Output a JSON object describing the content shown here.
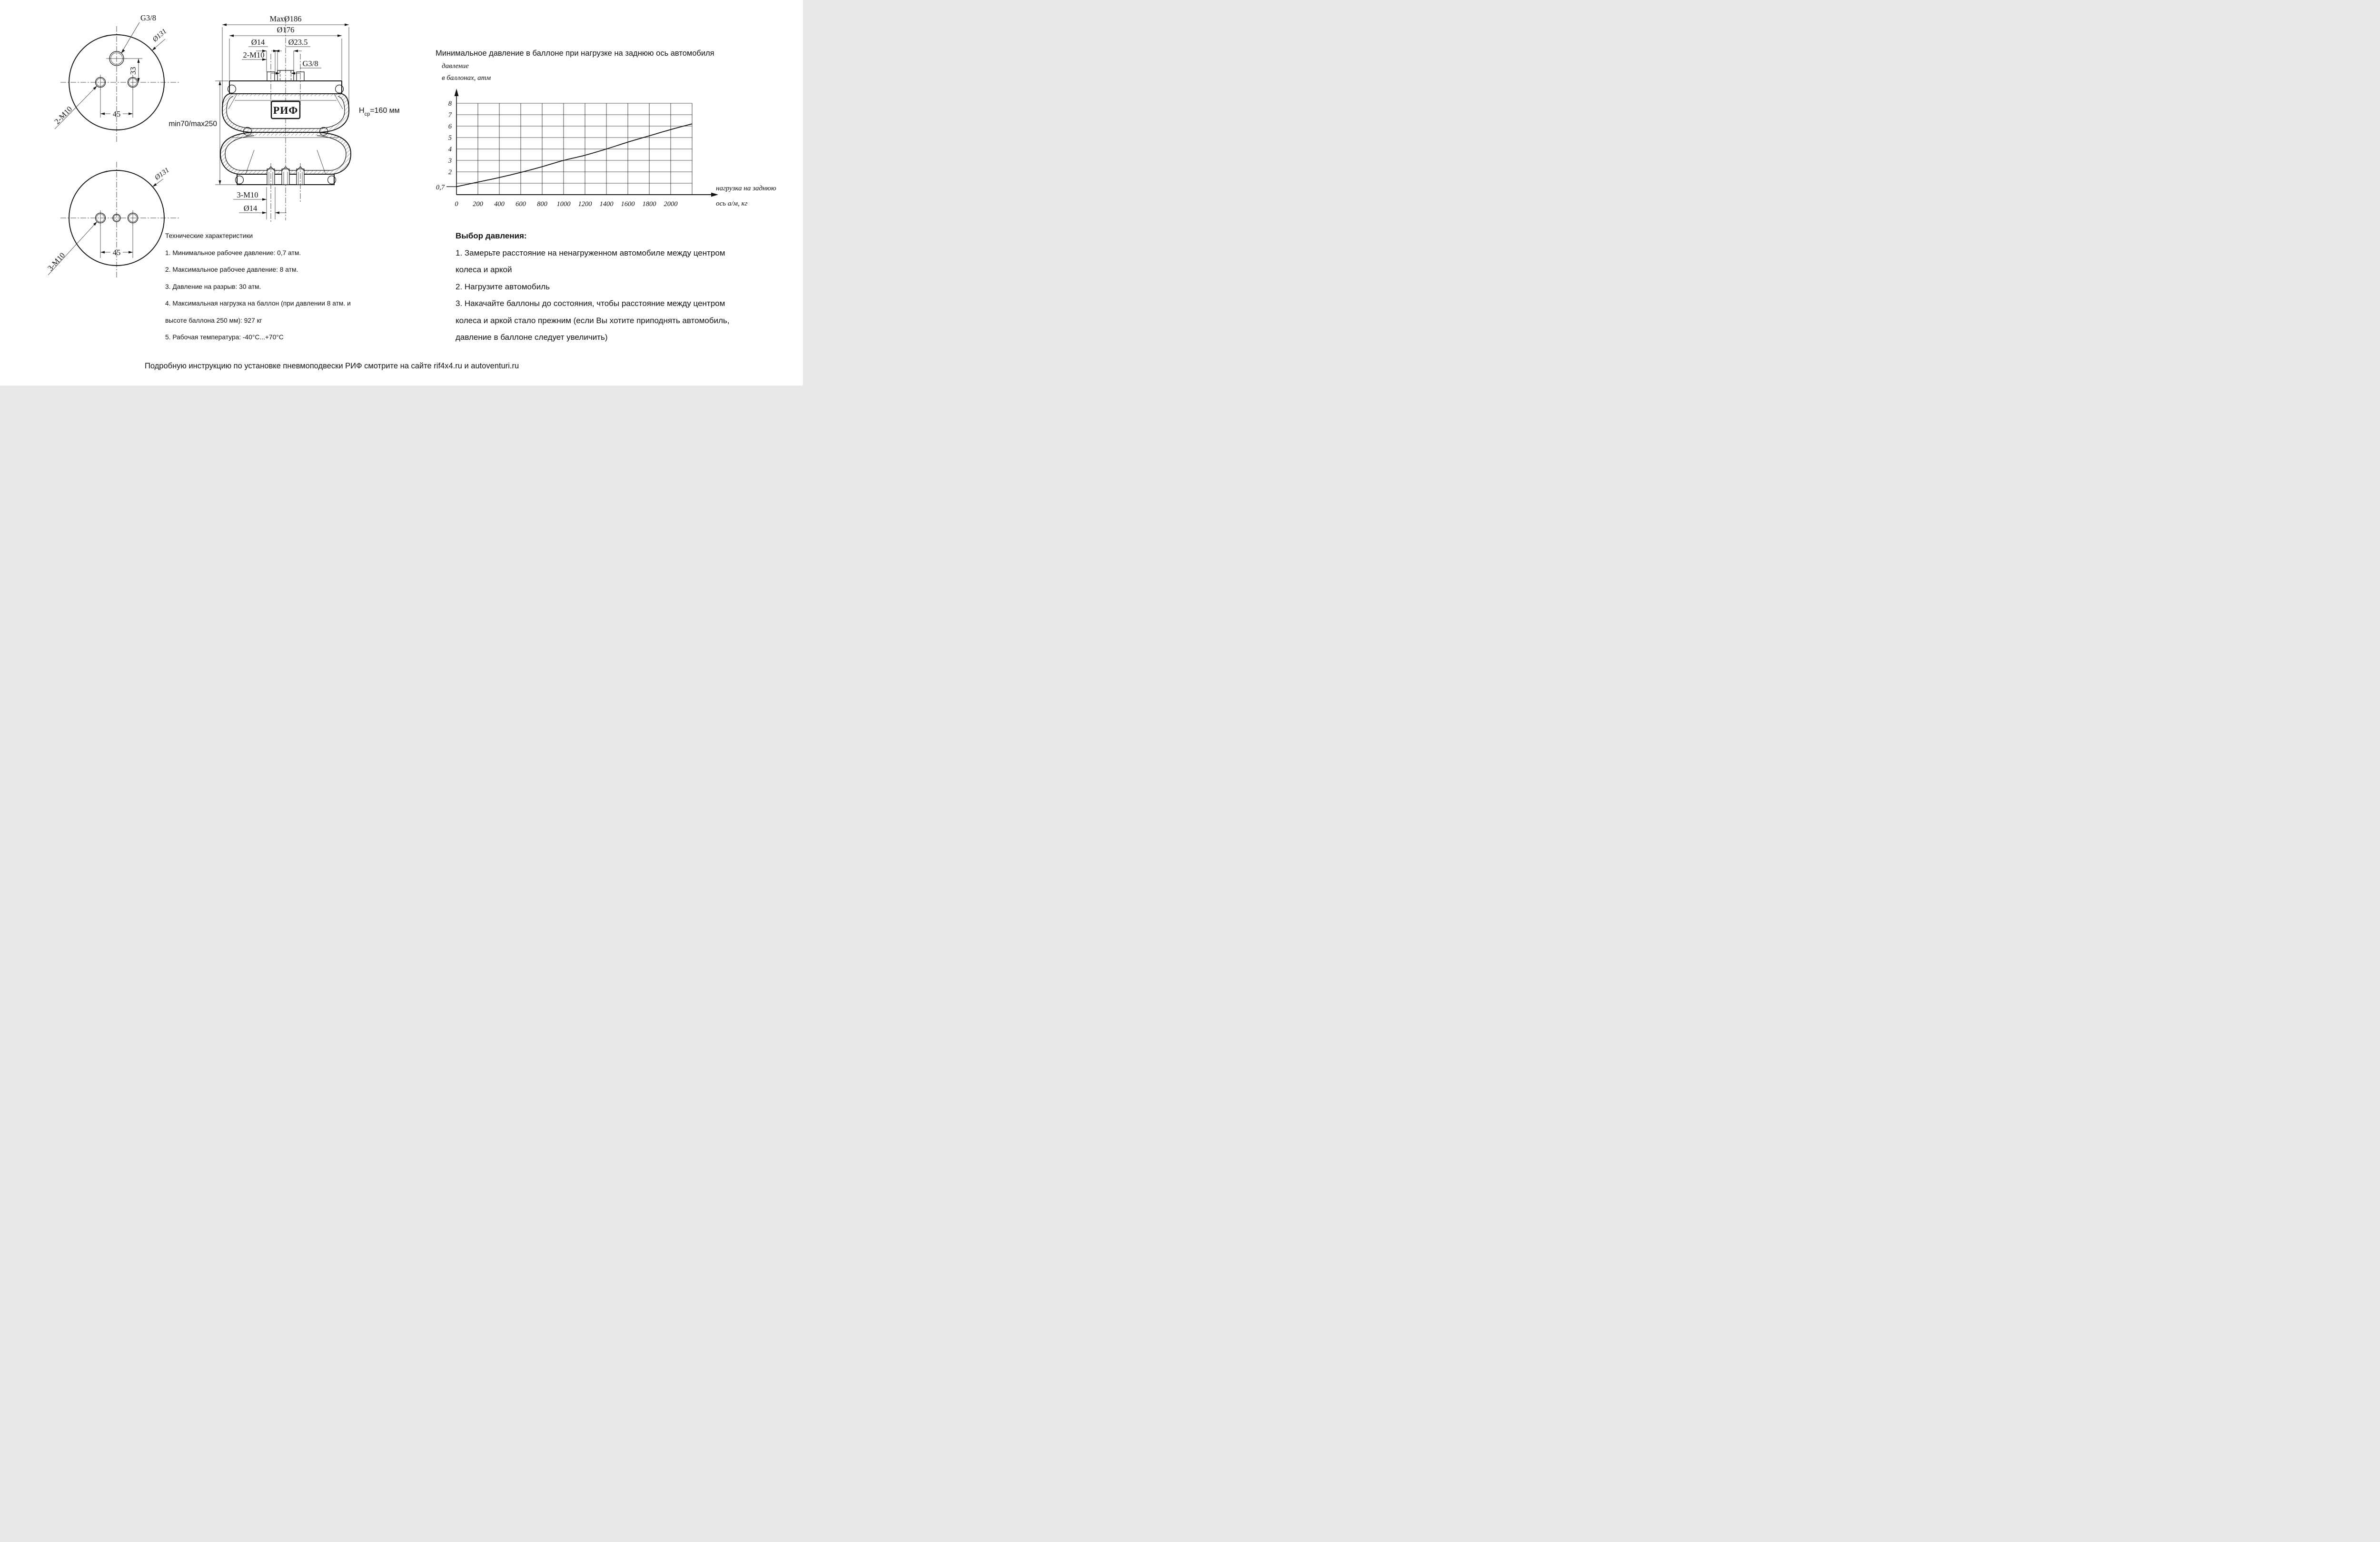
{
  "drawing": {
    "top_view": {
      "thread_label": "G3/8",
      "diameter_label": "Ø131",
      "holes_label": "2-М10",
      "vertical_dim": "33",
      "horizontal_dim": "45"
    },
    "bottom_view": {
      "diameter_label": "Ø131",
      "holes_label": "3-М10",
      "horizontal_dim": "45"
    },
    "section_view": {
      "max_diameter": "MaxØ186",
      "plate_diameter": "Ø176",
      "stud_diameter": "Ø14",
      "boss_diameter": "Ø23.5",
      "studs_label": "2-М10",
      "thread_label": "G3/8",
      "logo": "РИФ",
      "height_range": "min70/max250",
      "avg_height_base": "Н",
      "avg_height_sub": "ср",
      "avg_height_value": "=160 мм",
      "bottom_studs_label": "3-М10",
      "bottom_stud_diameter": "Ø14"
    }
  },
  "chart_data": {
    "type": "line",
    "title": "Минимальное давление в баллоне при нагрузке на заднюю ось автомобиля",
    "ylabel": "давление в баллонах, атм",
    "ylabel_lines": [
      "давление",
      "в баллонах, атм"
    ],
    "xlabel": "нагрузка на заднюю ось а/м, кг",
    "xlabel_lines": [
      "нагрузка на заднюю",
      "ось а/м, кг"
    ],
    "x": [
      0,
      200,
      400,
      600,
      800,
      1000,
      1200,
      1400,
      1600,
      1800,
      2000,
      2200
    ],
    "y": [
      0.7,
      1.1,
      1.5,
      1.95,
      2.45,
      3.0,
      3.45,
      4.0,
      4.6,
      5.15,
      5.7,
      6.2
    ],
    "x_ticks": [
      0,
      200,
      400,
      600,
      800,
      1000,
      1200,
      1400,
      1600,
      1800,
      2000
    ],
    "y_ticks": [
      2,
      3,
      4,
      5,
      6,
      7,
      8
    ],
    "y_grid": [
      1,
      2,
      3,
      4,
      5,
      6,
      7,
      8
    ],
    "x_grid_step": 200,
    "xlim": [
      0,
      2200
    ],
    "ylim": [
      0,
      8.5
    ],
    "y_start_label": "0,7",
    "y_start_value": 0.7,
    "grid": true
  },
  "tech_specs": {
    "title": "Технические характеристики",
    "lines": [
      "1. Минимальное рабочее давление: 0,7 атм.",
      "2. Максимальное рабочее давление: 8 атм.",
      "3. Давление на разрыв: 30 атм.",
      "4. Максимальная нагрузка на баллон (при давлении 8 атм. и",
      "высоте баллона 250 мм): 927 кг",
      "5. Рабочая температура: -40°С...+70°С"
    ]
  },
  "pressure_selection": {
    "title": "Выбор давления:",
    "lines": [
      "1. Замерьте расстояние на ненагруженном автомобиле между центром",
      "колеса и аркой",
      "2. Нагрузите автомобиль",
      "3. Накачайте баллоны до состояния, чтобы расстояние между центром",
      "колеса и аркой стало прежним (если Вы хотите приподнять автомобиль,",
      "давление в баллоне следует увеличить)"
    ]
  },
  "footer": "Подробную инструкцию по установке пневмоподвески РИФ смотрите на сайте rif4x4.ru и autoventuri.ru"
}
